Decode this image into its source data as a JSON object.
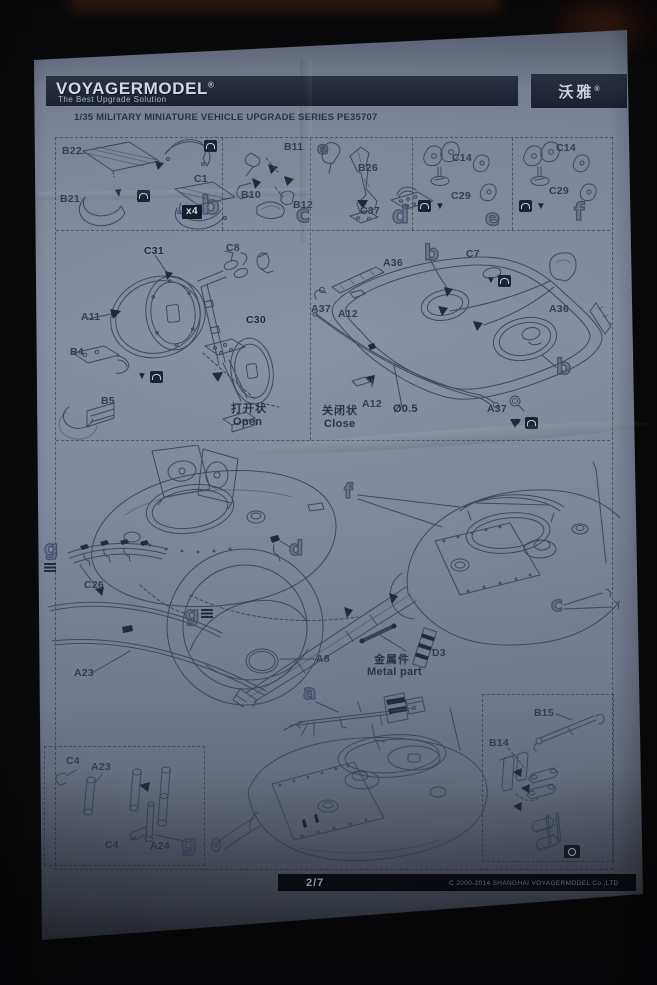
{
  "header": {
    "logo": "VOYAGERMODEL",
    "reg": "®",
    "tagline": "The Best Upgrade Solution",
    "brand_cn": "沃雅",
    "series_title": "1/35 MILITARY MINIATURE VEHICLE  UPGRADE SERIES PE35707"
  },
  "steps": {
    "a": "a",
    "b": "b",
    "c": "c",
    "d": "d",
    "e": "e",
    "f": "f",
    "g": "g"
  },
  "badges": {
    "x4": "x4"
  },
  "captions": {
    "open_cn": "打开状",
    "open_en": "Open",
    "close_cn": "关闭状",
    "close_en": "Close",
    "metal_cn": "金属件",
    "metal_en": "Metal part",
    "diameter": "Ø0.5"
  },
  "parts": {
    "A8": "A8",
    "A11": "A11",
    "A12": "A12",
    "A23": "A23",
    "A24": "A24",
    "A36": "A36",
    "A37": "A37",
    "B4": "B4",
    "B5": "B5",
    "B10": "B10",
    "B11": "B11",
    "B12": "B12",
    "B14": "B14",
    "B15": "B15",
    "B21": "B21",
    "B22": "B22",
    "B26": "B26",
    "C1": "C1",
    "C4": "C4",
    "C7": "C7",
    "C8": "C8",
    "C14": "C14",
    "C26": "C26",
    "C29": "C29",
    "C30": "C30",
    "C31": "C31",
    "C37": "C37",
    "D3": "D3"
  },
  "footer": {
    "page": "2/7",
    "copyright": "C 2000-2014 SHANGHAI VOYAGERMODEL Co.,LTD"
  }
}
